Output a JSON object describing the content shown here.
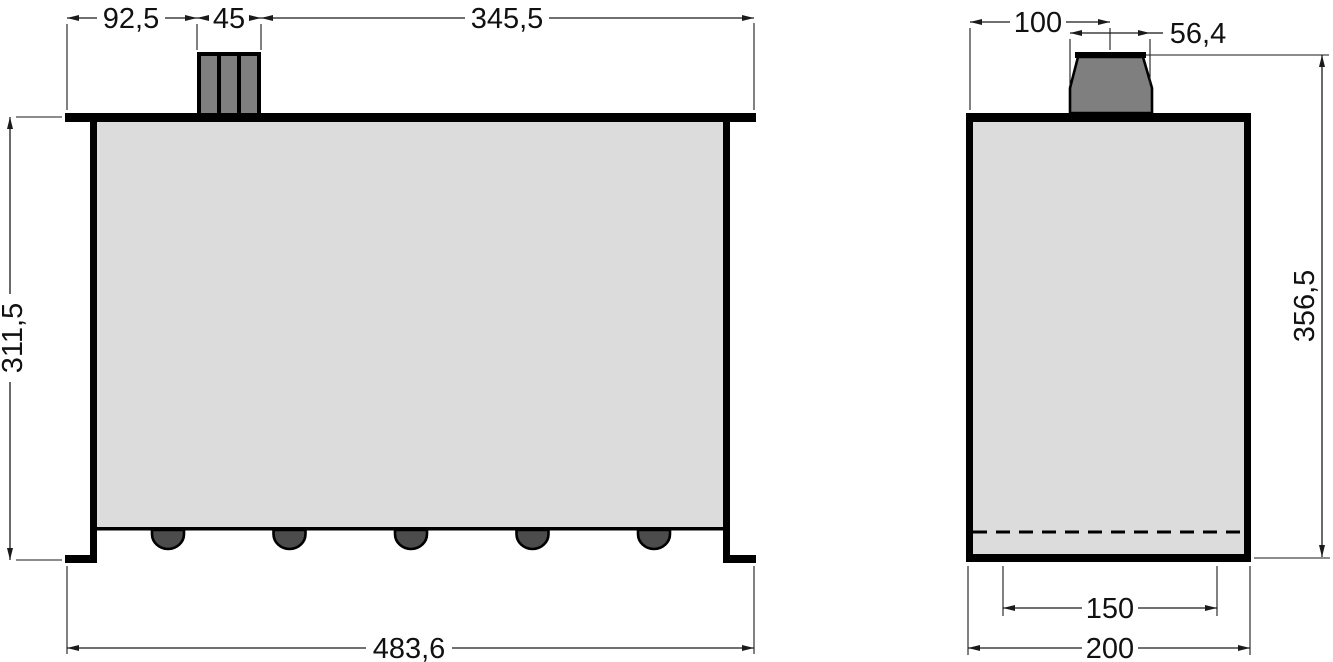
{
  "drawing": {
    "kind": "technical-orthographic-drawing",
    "views": [
      "front-view",
      "side-view"
    ]
  },
  "dims": {
    "front_top_left": "92,5",
    "front_block_width": "45",
    "front_top_right": "345,5",
    "front_height": "311,5",
    "front_total_width": "483,6",
    "side_cap_offset": "100",
    "side_cap_width": "56,4",
    "side_total_height": "356,5",
    "side_inner_width": "150",
    "side_total_width": "200"
  },
  "colors": {
    "background": "#ffffff",
    "body_fill": "#dcdcdc",
    "cap_fill": "#7f7f7f",
    "bump_fill": "#4c4c4c",
    "outline": "#000000",
    "dim_line": "#1a1a1a"
  }
}
